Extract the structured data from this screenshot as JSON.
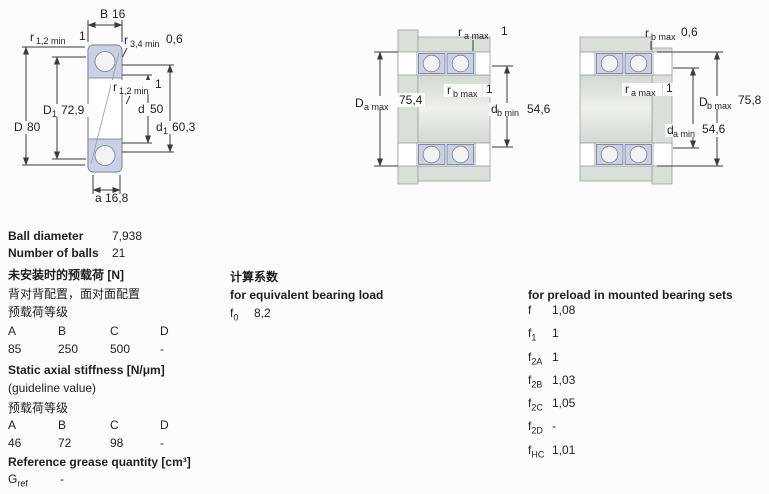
{
  "colors": {
    "ring": "#c9d1e8",
    "metal": "#dadfd9",
    "dimline": "#3a3a3a",
    "text": "#1f1f1f",
    "bg": "#fcfcfc"
  },
  "drawing_single": {
    "dim_B": {
      "label": "B",
      "value": "16"
    },
    "dim_a": {
      "label": "a",
      "value": "16,8"
    },
    "dim_D": {
      "label": "D",
      "value": "80"
    },
    "dim_d": {
      "label": "d",
      "value": "50"
    },
    "dim_D1": {
      "base": "D",
      "sub": "1",
      "value": "72,9"
    },
    "dim_d1": {
      "base": "d",
      "sub": "1",
      "value": "60,3"
    },
    "dim_r12_top": {
      "base": "r",
      "sub": "1,2 min",
      "value": "1"
    },
    "dim_r34_top": {
      "base": "r",
      "sub": "3,4 min",
      "value": "0,6"
    },
    "dim_r12_mid": {
      "base": "r",
      "sub": "1,2 min",
      "value": "1"
    }
  },
  "drawing_set_middle": {
    "dim_ra_top": {
      "base": "r",
      "sub": "a max",
      "value": "1"
    },
    "dim_rb_mid": {
      "base": "r",
      "sub": "b max",
      "value": "1"
    },
    "dim_Da": {
      "base": "D",
      "sub": "a max",
      "value": "75,4"
    },
    "dim_db": {
      "base": "d",
      "sub": "b min",
      "value": "54,6"
    }
  },
  "drawing_set_right": {
    "dim_rb_top": {
      "base": "r",
      "sub": "b max",
      "value": "0,6"
    },
    "dim_ra_mid": {
      "base": "r",
      "sub": "a max",
      "value": "1"
    },
    "dim_Db": {
      "base": "D",
      "sub": "b max",
      "value": "75,8"
    },
    "dim_da": {
      "base": "d",
      "sub": "a min",
      "value": "54,6"
    }
  },
  "specs": {
    "ball_diameter_label": "Ball diameter",
    "ball_diameter_value": "7,938",
    "number_of_balls_label": "Number of balls",
    "number_of_balls_value": "21",
    "preload": {
      "title": "未安装时的预载荷 [N]",
      "line1": "背对背配置，面对面配置",
      "line2": "预载荷等级",
      "headers": [
        "A",
        "B",
        "C",
        "D"
      ],
      "values": [
        "85",
        "250",
        "500",
        "-"
      ]
    },
    "stiffness": {
      "title": "Static axial stiffness [N/μm]",
      "line1": "(guideline value)",
      "line2": "预载荷等级",
      "headers": [
        "A",
        "B",
        "C",
        "D"
      ],
      "values": [
        "46",
        "72",
        "98",
        "-"
      ]
    },
    "grease": {
      "title": "Reference grease quantity [cm³]",
      "row_base": "G",
      "row_sub": "ref",
      "row_value": "-"
    }
  },
  "calc": {
    "title": "计算系数",
    "equiv_title": "for equivalent bearing load",
    "f0_base": "f",
    "f0_sub": "0",
    "f0_value": "8,2"
  },
  "preload_factors": {
    "title": "for preload in mounted bearing sets",
    "rows": [
      {
        "base": "f",
        "sub": "",
        "value": "1,08"
      },
      {
        "base": "f",
        "sub": "1",
        "value": "1"
      },
      {
        "base": "f",
        "sub": "2A",
        "value": "1"
      },
      {
        "base": "f",
        "sub": "2B",
        "value": "1,03"
      },
      {
        "base": "f",
        "sub": "2C",
        "value": "1,05"
      },
      {
        "base": "f",
        "sub": "2D",
        "value": "-"
      },
      {
        "base": "f",
        "sub": "HC",
        "value": "1,01"
      }
    ]
  }
}
